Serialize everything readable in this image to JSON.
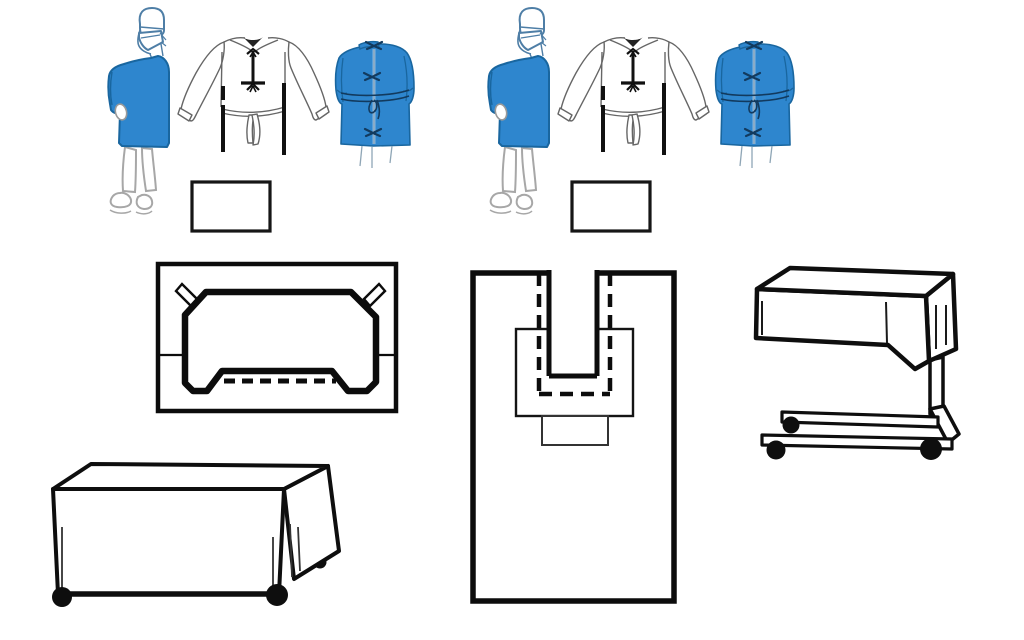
{
  "canvas": {
    "width_px": 1024,
    "height_px": 640,
    "background": "#ffffff"
  },
  "palette": {
    "gown_blue": "#2e86ce",
    "gown_blue_outline": "#19669f",
    "tie_navy": "#123a5e",
    "drawing_black": "#0c0c0c",
    "sketch_gray": "#9b9b9b",
    "outline_gray": "#666666",
    "head_outline_blue": "#4e7ea6",
    "paper_white": "#ffffff"
  },
  "illustrations": {
    "gown_set_left": {
      "surgeon_figure": "surgeon-wearing-blue-gown-cap-and-mask",
      "gown_back_outline": "gown-back-view-line-drawing-with-ties",
      "gown_back_filled": "blue-gown-back-view-with-ties",
      "caption_box_text": ""
    },
    "gown_set_right": {
      "surgeon_figure": "surgeon-wearing-blue-gown-cap-and-mask",
      "gown_back_outline": "gown-back-view-line-drawing-with-ties",
      "gown_back_filled": "blue-gown-back-view-with-ties",
      "caption_box_text": ""
    },
    "fenestrated_drape": "fenestrated-drape-with-corner-tabs-and-dashed-fold-line",
    "u_split_drape": "u-shaped-split-drape-with-reinforcement-patch-and-dashed-outline",
    "mayo_stand_cover": "covered-mayo-stand-on-casters",
    "back_table_cover": "draped-back-table-on-casters"
  }
}
